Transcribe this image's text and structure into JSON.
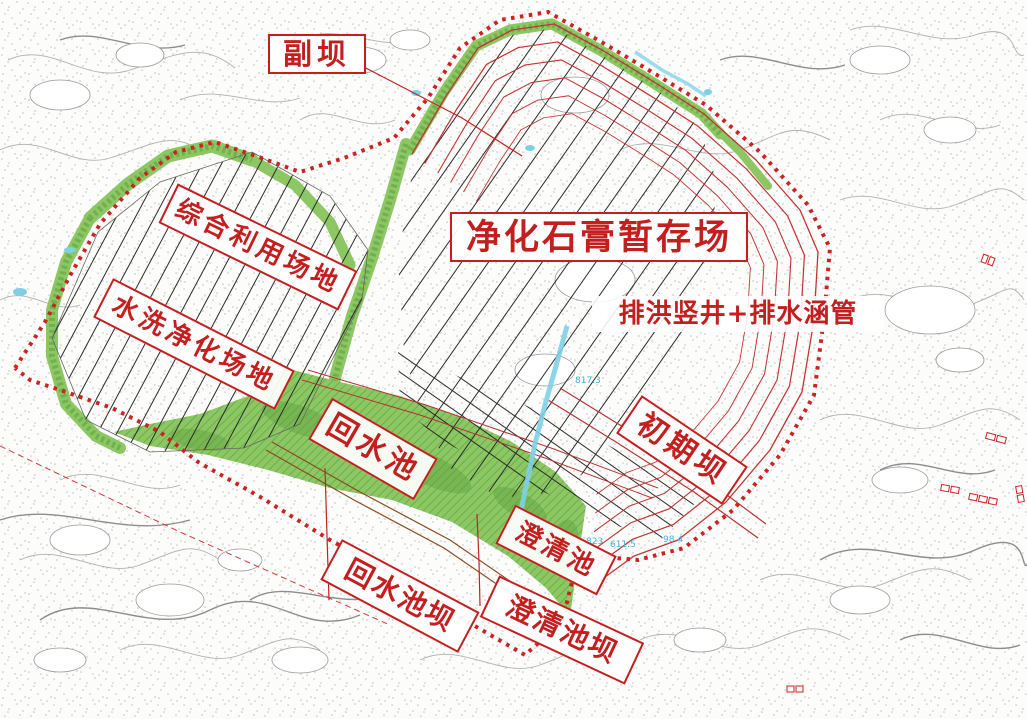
{
  "map": {
    "labels": {
      "auxiliary_dam": "副坝",
      "gypsum_storage_site": "净化石膏暂存场",
      "comprehensive_use_site": "综合利用场地",
      "washing_purification_site": "水洗净化场地",
      "flood_shaft_culvert": "排洪竖井+排水涵管",
      "initial_dam": "初期坝",
      "return_water_pool": "回水池",
      "clarification_pool": "澄清池",
      "return_water_pool_dam": "回水池坝",
      "clarification_pool_dam": "澄清池坝"
    },
    "elevation_marks": [
      "817.3",
      "823",
      "611.5",
      "98.4"
    ],
    "colors": {
      "annotation_red": "#c41f1f",
      "boundary_red": "#cc2222",
      "berm_contour_red": "#c23333",
      "vegetation_green": "#8cc764",
      "vegetation_dark_green": "#5ea23e",
      "water_cyan": "#5fc3de",
      "road_brown": "#8a4a22",
      "terrain_gray": "#9a9a9a",
      "hatch_black": "#2a2a2a"
    }
  }
}
